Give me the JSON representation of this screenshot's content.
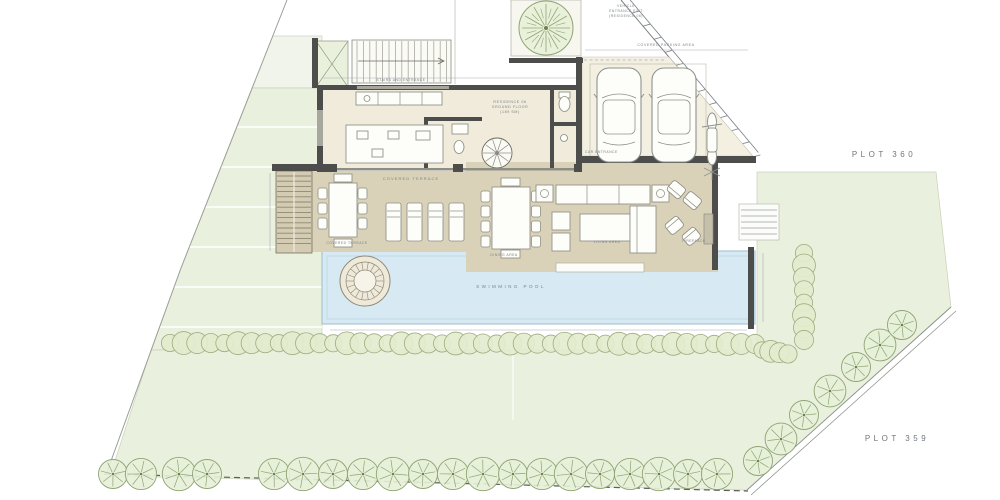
{
  "title": "Residence 06 ground floor site plan",
  "palette": {
    "lawn": "#e9f0de",
    "lawn_stroke": "#c8d2bc",
    "floor_cream": "#f0ebdb",
    "garage_cream": "#f3efe1",
    "terrace_tan": "#d9d2b8",
    "wall_dark": "#4d4d4b",
    "pool_blue": "#d7eaf3",
    "pool_stroke": "#9cbccd",
    "tree_green": "#e7efd8",
    "tree_stroke": "#8fa473",
    "hedge_green": "#e3ecce",
    "hedge_stroke": "#9cad7e",
    "label_gray": "#7c8287"
  },
  "labels": {
    "vehicle_line1": "VEHICLE",
    "vehicle_line2": "ENTRANCE EXIT",
    "vehicle_line3": "(RESIDENCE 06)",
    "covered_parking": "COVERED PARKING AREA",
    "car_entrance": "CAR ENTRANCE",
    "stairs_entrance": "STAIRS AND ENTRANCE",
    "residence_line1": "RESIDENCE 06",
    "residence_line2": "GROUND FLOOR",
    "residence_line3": "(189 SM)",
    "covered_terrace": "COVERED TERRACE",
    "covered_terrace_2": "COVERED TERRACE",
    "dining_area": "DINING AREA",
    "living_area": "LIVING AREA",
    "fireplace": "FIREPLACE",
    "swimming_pool": "SWIMMING POOL",
    "plot_360": "PLOT 360",
    "plot_359": "PLOT 359"
  }
}
